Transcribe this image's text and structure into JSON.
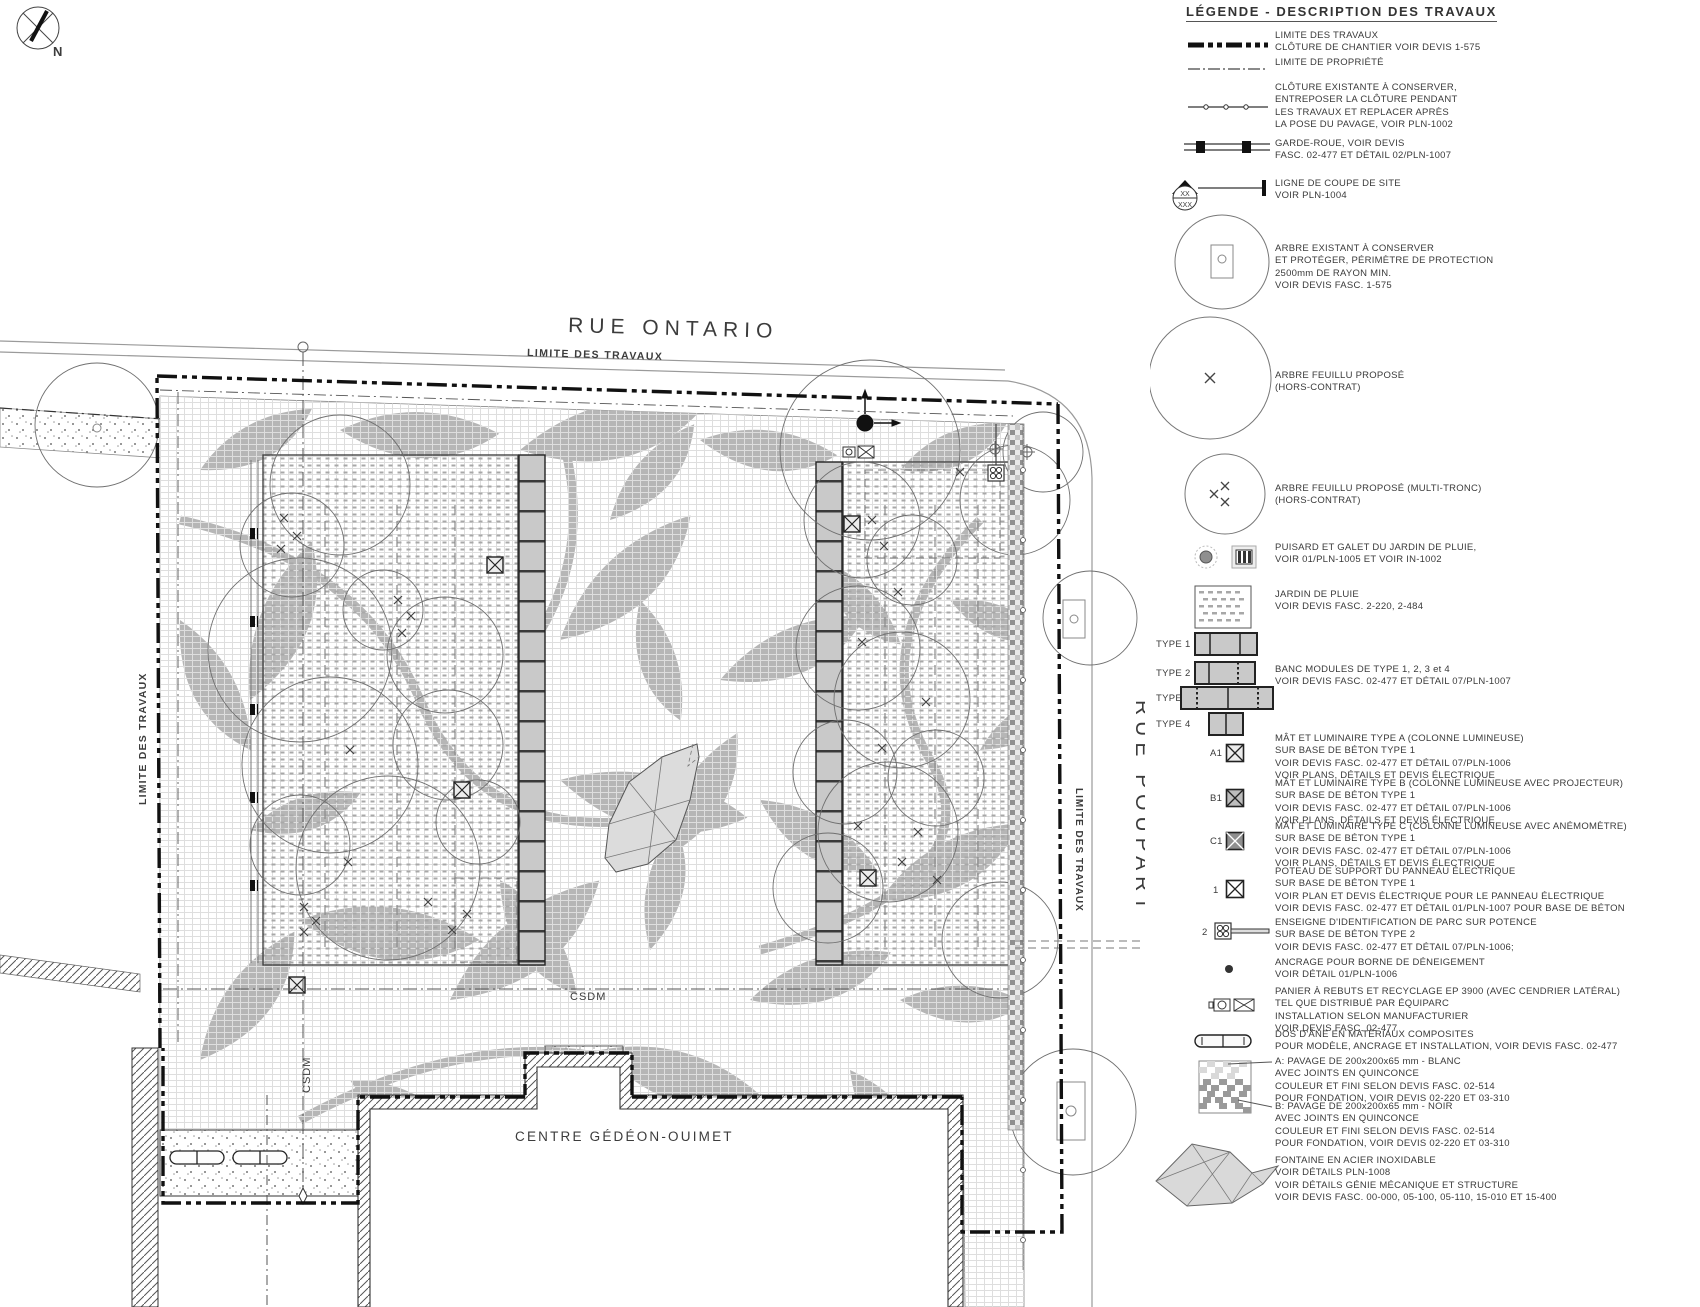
{
  "plan": {
    "north": "N",
    "rue_ontario": "RUE ONTARIO",
    "rue_poupart": "RUE POUPART",
    "limite_top": "LIMITE DES TRAVAUX",
    "limite_left": "LIMITE DES TRAVAUX",
    "limite_right": "LIMITE DES TRAVAUX",
    "csdm_horizontal": "CSDM",
    "csdm_vertical": "CSDM",
    "building": "CENTRE GÉDÉON-OUIMET"
  },
  "legend": {
    "title": "LÉGENDE - DESCRIPTION DES TRAVAUX",
    "items": [
      {
        "symbol": "work-limit-line",
        "lines": [
          "LIMITE DES TRAVAUX",
          "CLÔTURE DE CHANTIER VOIR DEVIS 1-575"
        ]
      },
      {
        "symbol": "property-line",
        "lines": [
          "LIMITE DE PROPRIÉTÉ"
        ]
      },
      {
        "symbol": "existing-fence-line",
        "lines": [
          "CLÔTURE EXISTANTE À CONSERVER,",
          "ENTREPOSER LA CLÔTURE PENDANT",
          "LES TRAVAUX ET REPLACER APRÈS",
          "LA POSE DU PAVAGE, VOIR PLN-1002"
        ]
      },
      {
        "symbol": "wheel-guard",
        "lines": [
          "GARDE-ROUE, VOIR DEVIS",
          "FASC. 02-477 ET DÉTAIL 02/PLN-1007"
        ]
      },
      {
        "symbol": "site-section-cut",
        "sym_top": "XX",
        "sym_bottom": "XXX",
        "lines": [
          "LIGNE DE COUPE DE SITE",
          "VOIR PLN-1004"
        ]
      },
      {
        "symbol": "existing-tree",
        "lines": [
          "ARBRE EXISTANT À CONSERVER",
          "ET PROTÉGER, PÉRIMÈTRE DE PROTECTION",
          "2500mm DE RAYON MIN.",
          "VOIR DEVIS FASC. 1-575"
        ]
      },
      {
        "symbol": "proposed-deciduous-tree",
        "lines": [
          "ARBRE FEUILLU PROPOSÉ",
          "(HORS-CONTRAT)"
        ]
      },
      {
        "symbol": "proposed-multistem-tree",
        "lines": [
          "ARBRE FEUILLU PROPOSÉ (MULTI-TRONC)",
          "(HORS-CONTRAT)"
        ]
      },
      {
        "symbol": "catch-basin",
        "lines": [
          "PUISARD ET GALET DU JARDIN DE PLUIE,",
          "VOIR 01/PLN-1005 ET VOIR IN-1002"
        ]
      },
      {
        "symbol": "rain-garden",
        "lines": [
          "JARDIN DE PLUIE",
          "VOIR DEVIS FASC. 2-220, 2-484"
        ]
      },
      {
        "symbol": "bench-modules",
        "types": [
          "TYPE 1",
          "TYPE 2",
          "TYPE 3",
          "TYPE 4"
        ],
        "lines": [
          "BANC MODULES DE TYPE 1, 2, 3 et 4",
          "VOIR DEVIS FASC. 02-477 ET DÉTAIL 07/PLN-1007"
        ]
      },
      {
        "symbol": "mast-luminaire-a",
        "tag": "A1",
        "lines": [
          "MÂT ET LUMINAIRE TYPE A (COLONNE LUMINEUSE)",
          "SUR BASE DE BÉTON TYPE 1",
          "VOIR DEVIS FASC. 02-477 ET DÉTAIL 07/PLN-1006",
          "VOIR PLANS, DÉTAILS ET DEVIS ÉLECTRIQUE"
        ]
      },
      {
        "symbol": "mast-luminaire-b",
        "tag": "B1",
        "lines": [
          "MÂT ET LUMINAIRE TYPE B (COLONNE LUMINEUSE AVEC PROJECTEUR)",
          "SUR BASE DE BÉTON TYPE 1",
          "VOIR DEVIS FASC. 02-477 ET DÉTAIL 07/PLN-1006",
          "VOIR PLANS, DÉTAILS ET DEVIS ÉLECTRIQUE"
        ]
      },
      {
        "symbol": "mast-luminaire-c",
        "tag": "C1",
        "lines": [
          "MÂT ET LUMINAIRE TYPE C (COLONNE LUMINEUSE AVEC ANÉMOMÈTRE)",
          "SUR BASE DE BÉTON TYPE 1",
          "VOIR DEVIS FASC. 02-477 ET DÉTAIL 07/PLN-1006",
          "VOIR PLANS, DÉTAILS ET DEVIS ÉLECTRIQUE"
        ]
      },
      {
        "symbol": "electric-panel-post",
        "tag": "1",
        "lines": [
          "POTEAU DE SUPPORT DU PANNEAU ÉLECTRIQUE",
          "SUR BASE DE BÉTON TYPE 1",
          "VOIR PLAN ET DEVIS ÉLECTRIQUE POUR LE PANNEAU ÉLECTRIQUE",
          "VOIR DEVIS FASC. 02-477 ET DÉTAIL 01/PLN-1007 POUR BASE DE BÉTON"
        ]
      },
      {
        "symbol": "park-sign",
        "tag": "2",
        "lines": [
          "ENSEIGNE D'IDENTIFICATION DE PARC SUR POTENCE",
          "SUR BASE DE BÉTON TYPE 2",
          "VOIR DEVIS FASC. 02-477 ET DÉTAIL 07/PLN-1006;"
        ]
      },
      {
        "symbol": "snow-post-anchor",
        "lines": [
          "ANCRAGE POUR BORNE DE DÉNEIGEMENT",
          "VOIR DÉTAIL 01/PLN-1006"
        ]
      },
      {
        "symbol": "waste-recycling-bin",
        "lines": [
          "PANIER À REBUTS ET RECYCLAGE EP 3900 (AVEC CENDRIER LATÉRAL)",
          "TEL QUE DISTRIBUÉ PAR ÉQUIPARC",
          "INSTALLATION SELON MANUFACTURIER",
          "VOIR DEVIS FASC. 02-477"
        ]
      },
      {
        "symbol": "speed-bump",
        "lines": [
          "DOS D'ÂNE EN MATÉRIAUX COMPOSITES",
          "POUR MODÈLE, ANCRAGE ET INSTALLATION, VOIR DEVIS FASC. 02-477"
        ]
      },
      {
        "symbol": "paving-a",
        "lines": [
          "A: PAVAGE DE 200x200x65 mm - BLANC",
          "AVEC JOINTS EN QUINCONCE",
          "COULEUR ET FINI SELON DEVIS FASC. 02-514",
          "POUR FONDATION, VOIR DEVIS 02-220 ET 03-310"
        ]
      },
      {
        "symbol": "paving-b",
        "lines": [
          "B: PAVAGE DE 200x200x65 mm - NOIR",
          "AVEC JOINTS EN QUINCONCE",
          "COULEUR ET FINI SELON DEVIS FASC. 02-514",
          "POUR FONDATION, VOIR DEVIS 02-220 ET 03-310"
        ]
      },
      {
        "symbol": "fountain",
        "lines": [
          "FONTAINE EN ACIER INOXIDABLE",
          "VOIR DÉTAILS PLN-1008",
          "VOIR DÉTAILS GÉNIE MÉCANIQUE ET STRUCTURE",
          "VOIR DEVIS FASC. 00-000, 05-100, 05-110, 15-010 ET 15-400"
        ]
      }
    ]
  }
}
